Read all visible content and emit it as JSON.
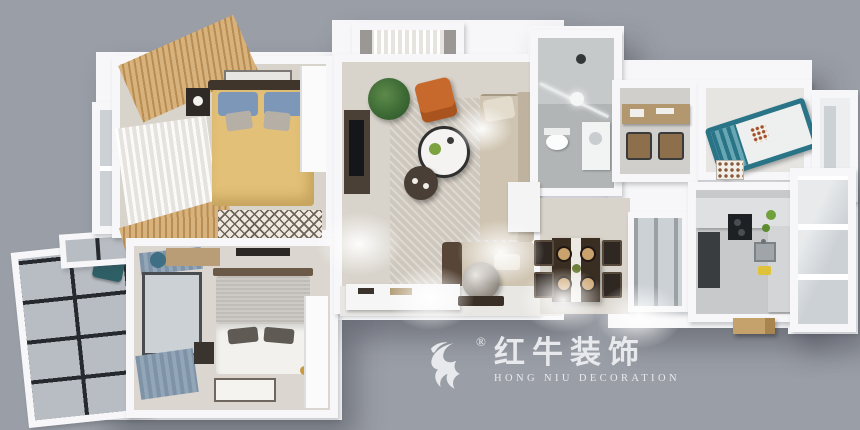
{
  "watermark": {
    "icon": "bull-swoosh-icon",
    "registered": "®",
    "brand_cn": "红牛装饰",
    "brand_en": "HONG NIU DECORATION",
    "text_color": "#edeef1"
  },
  "scene": {
    "type": "3d-interior-floorplan-render",
    "view": "top-down axonometric apartment model on gray backdrop",
    "rooms": [
      {
        "id": "bedroom-main",
        "items": [
          "double-bed-yellow-duvet",
          "blue-pillows",
          "wood-slat-wardrobe",
          "sheer-curtain",
          "nightstand",
          "diamond-rug",
          "white-wardrobe",
          "side-window-bay"
        ]
      },
      {
        "id": "bedroom-second",
        "items": [
          "double-bed-gray-blanket",
          "blue-gray-window-curtains",
          "nightstand-with-gold-lamp",
          "wall-tv",
          "desk-with-teal-chair",
          "white-bordered-rug",
          "white-wardrobe"
        ]
      },
      {
        "id": "balcony-west",
        "items": [
          "black-frame-glass-windows",
          "teal-chair"
        ]
      },
      {
        "id": "living-room",
        "items": [
          "beige-sectional-sofa",
          "orange-accent-chair",
          "round-coffee-table",
          "round-side-table",
          "dark-tv-console",
          "potted-plant",
          "textured-area-rug",
          "sheer-balcony-curtains"
        ]
      },
      {
        "id": "bathroom",
        "items": [
          "glass-shower",
          "toilet",
          "vanity-sink",
          "round-ceiling-light",
          "gray-tile"
        ]
      },
      {
        "id": "study-nook",
        "items": [
          "wood-desk",
          "two-chairs"
        ]
      },
      {
        "id": "kids-bedroom",
        "items": [
          "teal-frame-bed",
          "patterned-rug"
        ]
      },
      {
        "id": "dining-area",
        "items": [
          "dark-wood-table",
          "four-chairs",
          "white-runner",
          "place-settings"
        ]
      },
      {
        "id": "kitchen",
        "items": [
          "l-shaped-counter",
          "dark-cooktop",
          "steel-sink",
          "tall-dark-unit",
          "wood-step-outside"
        ]
      },
      {
        "id": "utility-balcony",
        "items": [
          "white-frame-glass-enclosure"
        ]
      },
      {
        "id": "entry-hall",
        "items": [
          "white-shoe-cabinet",
          "round-decor-mirror",
          "ceiling-downlights"
        ]
      }
    ]
  },
  "palette": {
    "background": "#9a9ea6",
    "wall": "#f7f7f9",
    "floor_warm": "#d8d3cb",
    "floor_cool": "#c7c9ca",
    "glass": "#ccd1d5",
    "window_frame_dark": "#26292d",
    "wood": "#c49a62",
    "duvet_yellow": "#e3c077",
    "pillow_blue": "#7d97b9",
    "sofa_beige": "#cfc4b1",
    "accent_orange": "#c7692d",
    "plant_green": "#3e6b35",
    "kids_bed_teal": "#2a7487",
    "blanket_gray": "#c7c4c0",
    "curtain_blue_gray": "#7e93a8",
    "dining_table_dark": "#3a2d21",
    "bath_tile": "#b2b5b6",
    "gold_lamp": "#c99a3f",
    "logo_white": "#edeef1"
  }
}
